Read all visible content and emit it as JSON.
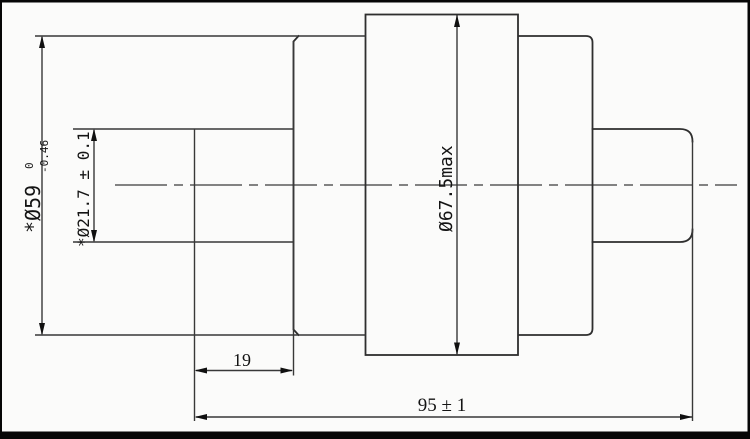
{
  "drawing": {
    "type": "mechanical-part-section-view",
    "part_shape": "stepped shaft / track roller with center flange",
    "dimensions": {
      "outer_diameter": {
        "text": "*Ø59",
        "tolerance_upper": "0",
        "tolerance_lower": "-0.46"
      },
      "hub_diameter": {
        "text": "*Ø21.7 ± 0.1"
      },
      "flange_diameter": {
        "text": "Ø67.5max"
      },
      "step_length": {
        "text": "19"
      },
      "overall_length": {
        "text": "95 ± 1"
      }
    },
    "colors": {
      "background": "#fbfbfa",
      "line": "#2e2e2e",
      "frame": "#060606",
      "text": "#141414"
    }
  }
}
